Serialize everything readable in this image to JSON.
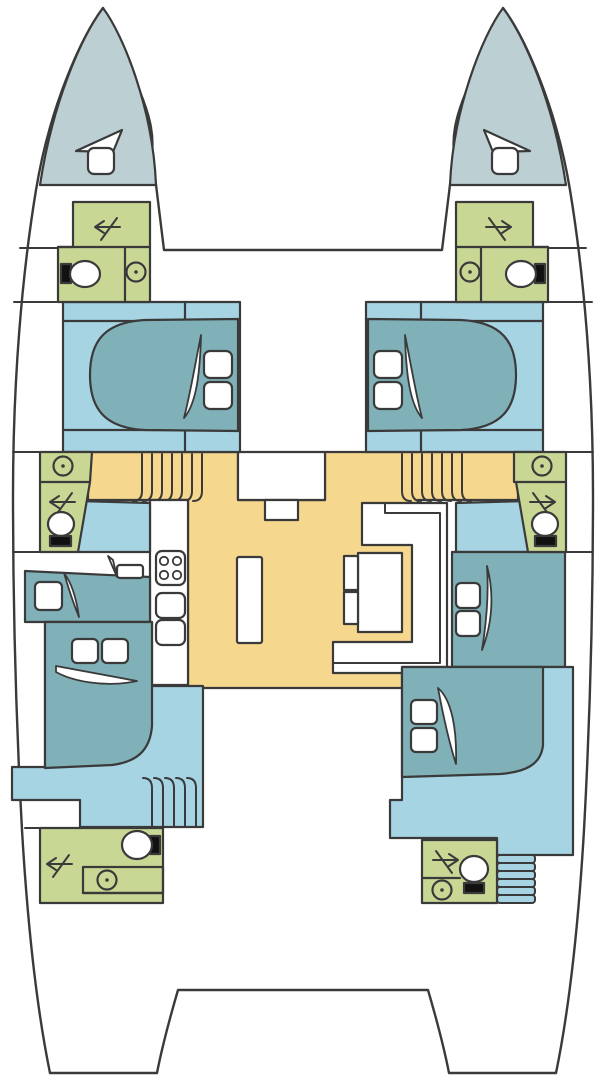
{
  "diagram": {
    "title": "Catamaran deck floor plan",
    "type": "floor-plan",
    "text_labels": []
  },
  "palette": {
    "outline": "#3a3a3a",
    "deck": "#ffffff",
    "bow_locker": "#bccfd3",
    "bathroom": "#c9d795",
    "cabin_floor": "#a6d4e3",
    "bed": "#80b1b8",
    "salon_floor": "#f5d78e",
    "fixture_white": "#ffffff",
    "tank_black": "#111111"
  },
  "zones": {
    "port_bow_locker": "port bow locker",
    "starboard_bow_locker": "starboard bow locker",
    "port_forward_bathroom": "port forward bathroom",
    "starboard_forward_bathroom": "starboard forward bathroom",
    "port_forward_cabin": "port forward cabin",
    "starboard_forward_cabin": "starboard forward cabin",
    "salon": "salon / cockpit floor",
    "galley": "galley counter",
    "dinette": "dinette table and sofa",
    "port_mid_bathroom": "port mid bathroom",
    "starboard_mid_bathroom": "starboard mid bathroom",
    "port_mid_berth": "port mid berth",
    "starboard_mid_berth": "starboard mid berth",
    "port_aft_cabin": "port aft cabin",
    "starboard_aft_cabin": "starboard aft cabin",
    "port_aft_bathroom": "port aft bathroom",
    "starboard_aft_bathroom": "starboard aft bathroom",
    "aft_platform": "aft platform",
    "trampoline": "foredeck between bows"
  },
  "icons": {
    "toilet": "toilet bowl with tank",
    "sink": "round sink with drain dot",
    "door_swing_arrow": "door swing arrow",
    "hatch": "deck hatch",
    "vent": "bow vent triangle",
    "stove": "4-burner stove",
    "galley_sink": "double galley sink",
    "pillow": "bed pillow",
    "blanket": "folded blanket",
    "stairs": "companionway steps"
  }
}
